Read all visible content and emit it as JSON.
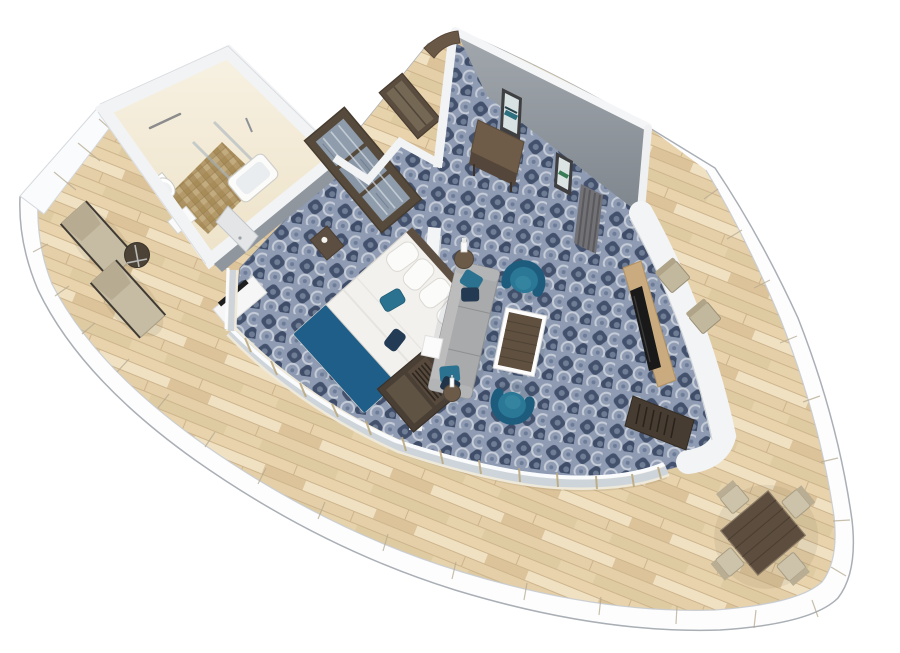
{
  "scene": {
    "title": "3D rendered floor plan of a curved aft cruise-ship suite with wraparound balcony",
    "type": "3d-floorplan-render",
    "rooms": [
      "bathroom",
      "wardrobe-closet",
      "entry-foyer",
      "bedroom",
      "living-area",
      "wraparound-balcony"
    ],
    "furniture": {
      "bathroom": [
        "toilet",
        "bathtub",
        "glass-shower",
        "towel-bar",
        "vanity",
        "door"
      ],
      "bedroom": [
        "double-bed-with-blue-runner",
        "pillows",
        "nightstand",
        "tv-desk",
        "open-wardrobe",
        "divider-wall"
      ],
      "living": [
        "gray-sofa-with-teal-pillows",
        "two-teal-tub-chairs",
        "wood-coffee-table",
        "lamp-side-table",
        "white-cube-table",
        "bottle-side-table",
        "tv-panel",
        "hanging-closet"
      ],
      "entry": [
        "curved-wood-door",
        "console-bench",
        "framed-art-1",
        "framed-art-2",
        "curtain-panel"
      ],
      "balcony": [
        "two-sun-loungers",
        "round-drink-table",
        "square-dining-table",
        "four-dining-chairs",
        "two-balcony-chairs"
      ]
    },
    "palette": {
      "hull_white": "#fdfdfe",
      "hull_outline": "#a9afb5",
      "railing_seam": "#b6aa90",
      "deck_wood": "#ecd9b7",
      "deck_wood_dark": "#cdb48c",
      "carpet_base": "#8e9bb2",
      "carpet_dark": "#43516d",
      "carpet_light": "#cfd5de",
      "wall_white": "#f3f4f6",
      "wall_gray": "#8d949b",
      "bathroom_wall": "#f4ecd9",
      "bathroom_floor": "#b09662",
      "wood_dark": "#564a3c",
      "wood_mid": "#6e5c49",
      "wood_panel": "#c9ab7f",
      "sofa_gray": "#a9aaab",
      "teal_chair": "#2a7796",
      "teal_dark": "#1d5c7c",
      "bed_blue": "#1f5e88",
      "pillow_navy": "#233a52",
      "lounger_beige": "#c6bca4",
      "glass_blue": "#c6cfd9",
      "tv_black": "#191919"
    }
  }
}
